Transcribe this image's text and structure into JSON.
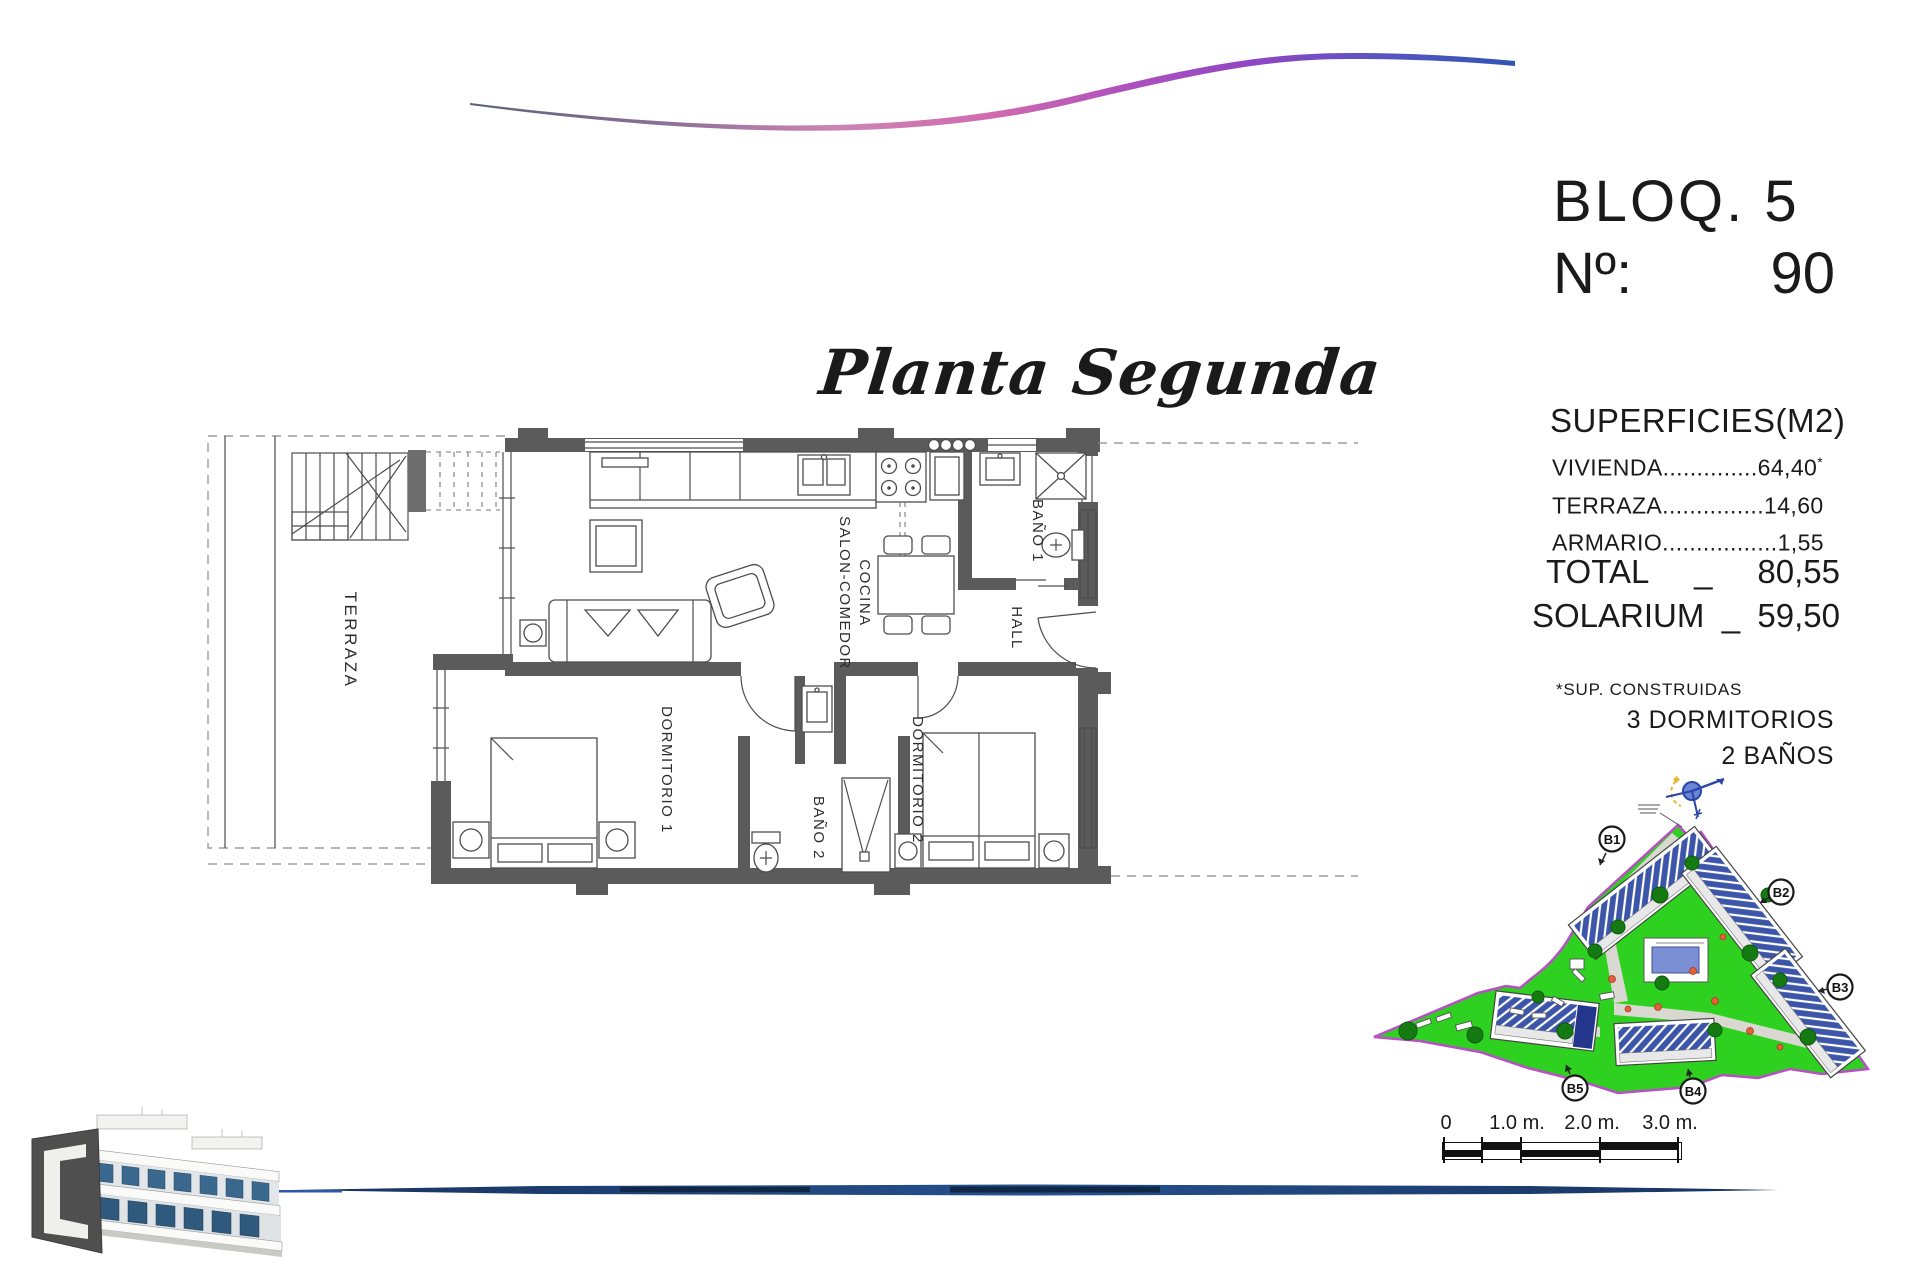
{
  "header": {
    "bloq": "BLOQ. 5",
    "num_label": "Nº:",
    "num_value": "90"
  },
  "plan_title": "Planta Segunda",
  "superficies": {
    "heading": "SUPERFICIES(M2)",
    "rows": [
      {
        "label": "VIVIENDA",
        "dots": "..............",
        "value": "64,40",
        "star": "*"
      },
      {
        "label": "TERRAZA",
        "dots": "...............",
        "value": "14,60",
        "star": ""
      },
      {
        "label": "ARMARIO",
        "dots": ".................",
        "value": "1,55",
        "star": ""
      }
    ],
    "total_label": "TOTAL",
    "total_sep": "_",
    "total_value": "80,55",
    "solarium_label": "SOLARIUM",
    "solarium_sep": "_",
    "solarium_value": "59,50",
    "footnote": "*SUP. CONSTRUIDAS",
    "bedrooms": "3 DORMITORIOS",
    "bathrooms": "2 BAÑOS"
  },
  "floorplan": {
    "terraza": "TERRAZA",
    "salon_line1": "SALON-COMEDOR",
    "salon_line2": "COCINA",
    "bano1": "BAÑO 1",
    "hall": "HALL",
    "dorm1": "DORMITORIO 1",
    "bano2": "BAÑO 2",
    "dorm2": "DORMITORIO 2"
  },
  "siteplan": {
    "b1": "B1",
    "b2": "B2",
    "b3": "B3",
    "b4": "B4",
    "b5": "B5"
  },
  "scalebar": {
    "t0": "0",
    "t1": "1.0 m.",
    "t2": "2.0 m.",
    "t3": "3.0 m."
  },
  "colors": {
    "site_green": "#2fd120",
    "site_border": "#b94fc4",
    "roof_blue": "#3c55a8",
    "pool_blue": "#7b8fd4",
    "bottom_line": "#1c3f7e",
    "wave_pink": "#d06ab0",
    "wave_purple": "#8f46c4",
    "wave_blue": "#2f55b4"
  }
}
